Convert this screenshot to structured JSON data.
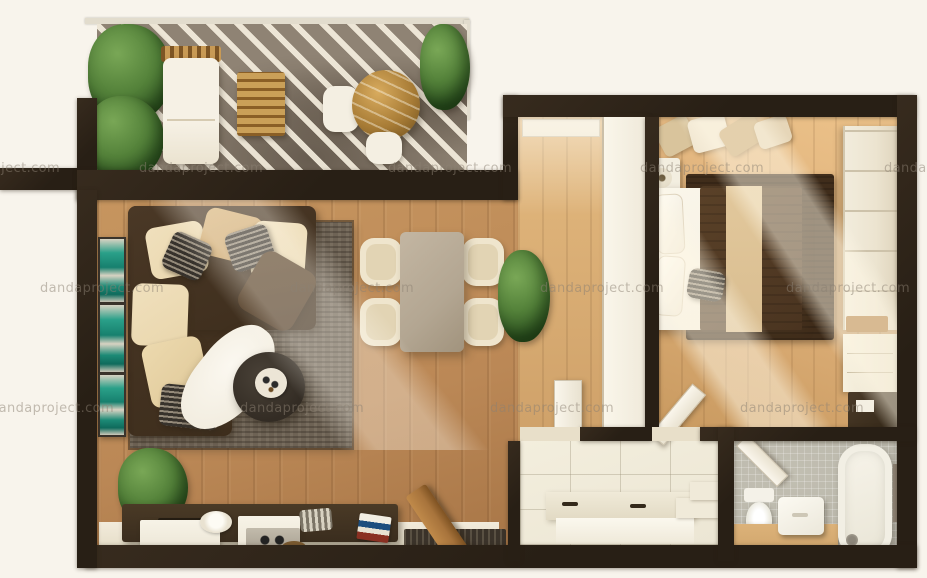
{
  "watermark": {
    "text": "dandaproject.com"
  },
  "palette": {
    "bg": "#f8f4ec",
    "wall": "#281f15",
    "wood_living": "#bb8856",
    "wood_corridor": "#cfa169",
    "wood_bedroom": "#dcae77",
    "balcony_floor": "#8f8374",
    "balcony_stripe": "#f6efdd",
    "rug_living": "#6e6355",
    "rug_bedroom": "#402d1b",
    "sofa_base": "#3e2e1d",
    "cushion_cream": "#e9d6ac",
    "dining_table": "#b3a692",
    "chair_cream": "#efe5cd",
    "bed_duvet": "#4a3420",
    "bed_runner": "#d9bd90",
    "linen_white": "#f5efe1",
    "wardrobe_cream": "#ece4d0",
    "tile_entry": "#ece6d4",
    "bath_floor": "#b7b4a8",
    "vanity_wood": "#d2a76e",
    "plant_green": "#54823a",
    "teal_art": "#17806e",
    "console_wood": "#3a2d1e",
    "door_wood": "#a8743c",
    "watermark_color": "#8c8173"
  },
  "scene": {
    "type": "3d-rendered-apartment-floor-plan-top-down",
    "rooms": [
      {
        "name": "balcony-terrace",
        "furniture": [
          "potted-plants",
          "lounge-chair-with-canopy",
          "wood-slat-table",
          "round-marble-table",
          "white-chairs"
        ]
      },
      {
        "name": "living-room",
        "furniture": [
          "corner-sofa-with-cushions",
          "gray-area-rug",
          "round-coffee-table-with-tray",
          "sheepskin-rug",
          "teal-wall-art-frames",
          "tv-console-with-objects",
          "potted-plant",
          "wooden-entry-door",
          "doormat"
        ]
      },
      {
        "name": "dining-area",
        "furniture": [
          "rectangular-table",
          "four-cream-chairs",
          "potted-plant"
        ]
      },
      {
        "name": "corridor",
        "furniture": [
          "white-wardrobe-partition"
        ]
      },
      {
        "name": "bedroom",
        "furniture": [
          "double-bed-dark-duvet",
          "white-pillows",
          "nightstand-with-lamp",
          "dark-rug",
          "clothes-rack",
          "cream-wardrobe",
          "drawer-unit",
          "desk"
        ]
      },
      {
        "name": "entry-hall",
        "furniture": [
          "built-in-closet",
          "steps"
        ]
      },
      {
        "name": "bathroom",
        "furniture": [
          "toilet",
          "vessel-sink-on-wood-vanity",
          "bathtub",
          "wall-shelf"
        ]
      }
    ]
  }
}
